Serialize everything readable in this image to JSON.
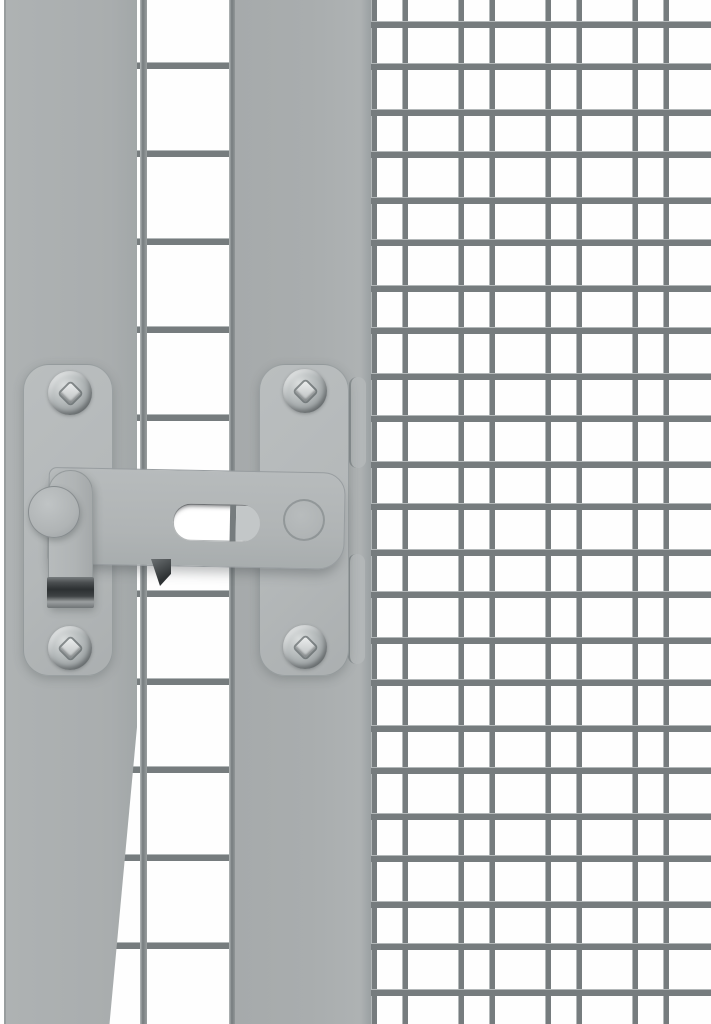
{
  "scene": {
    "subject": "gray-metal-gate-latch-on-wire-mesh-panel",
    "components": [
      "frame-post-left",
      "frame-post-middle",
      "large-square-mesh",
      "fine-double-mesh",
      "mounting-plate-left",
      "mounting-plate-right",
      "latch-bar",
      "latch-bar-slot",
      "latch-arm",
      "latch-catch-clip",
      "pivot-knob",
      "bar-pivot",
      "mounting-screws",
      "strike-edge-tabs"
    ]
  },
  "palette": {
    "background": "#fefefe",
    "post": "#a9adae",
    "plate": "#b4b8b9",
    "plate_light": "#babebf",
    "bar": "#b0b4b5",
    "wire_dark": "#767c7e",
    "wire_light": "#b3b8b9",
    "screw_hi": "#dadddd",
    "screw_mid": "#b5babb",
    "screw_dark": "#868c8e",
    "clip_dark": "#2c3032",
    "clip_mid": "#4a4e50",
    "clip_light": "#9b9fa0",
    "slot_pin": "#c3c7c8",
    "edge_line": "#989d9e"
  },
  "mesh": {
    "right_fine": {
      "horizontal": {
        "period": 88,
        "wire": 7,
        "offsets": [
          21,
          63
        ]
      },
      "vertical": {
        "period": 87,
        "wire": 6,
        "offsets": [
          3,
          34
        ]
      }
    },
    "left_large": {
      "horizontal": {
        "period": 88,
        "wire": 7,
        "offsets": [
          62
        ]
      },
      "vertical_wires": [
        {
          "x": 140,
          "y": 0,
          "w": 7,
          "h": 1024
        },
        {
          "x": 229,
          "y": 0,
          "w": 7,
          "h": 1024
        }
      ]
    }
  },
  "geometry": {
    "plates": [
      {
        "x": 23,
        "y": 364,
        "w": 90,
        "h": 312
      },
      {
        "x": 259,
        "y": 364,
        "w": 90,
        "h": 312
      }
    ],
    "screws": [
      {
        "x": 48,
        "y": 371,
        "w": 44,
        "h": 44
      },
      {
        "x": 48,
        "y": 626,
        "w": 44,
        "h": 44
      },
      {
        "x": 283,
        "y": 369,
        "w": 44,
        "h": 44
      },
      {
        "x": 283,
        "y": 625,
        "w": 44,
        "h": 44
      }
    ],
    "edge_tabs": [
      {
        "x": 349,
        "y": 377,
        "w": 17,
        "h": 91
      },
      {
        "x": 348,
        "y": 554,
        "w": 17,
        "h": 110
      }
    ],
    "bar": {
      "x": 48,
      "y": 467,
      "w": 297,
      "h": 97
    },
    "wedge": {
      "x": 151,
      "y": 559,
      "w": 20,
      "h": 27
    },
    "arm": {
      "x": 48,
      "y": 470,
      "w": 45,
      "h": 137
    },
    "clip": {
      "x": 47,
      "y": 577,
      "w": 47,
      "h": 31
    },
    "knob": {
      "x": 28,
      "y": 486,
      "w": 52,
      "h": 52
    },
    "pivot": {
      "x": 283,
      "y": 499,
      "w": 42,
      "h": 42
    }
  }
}
